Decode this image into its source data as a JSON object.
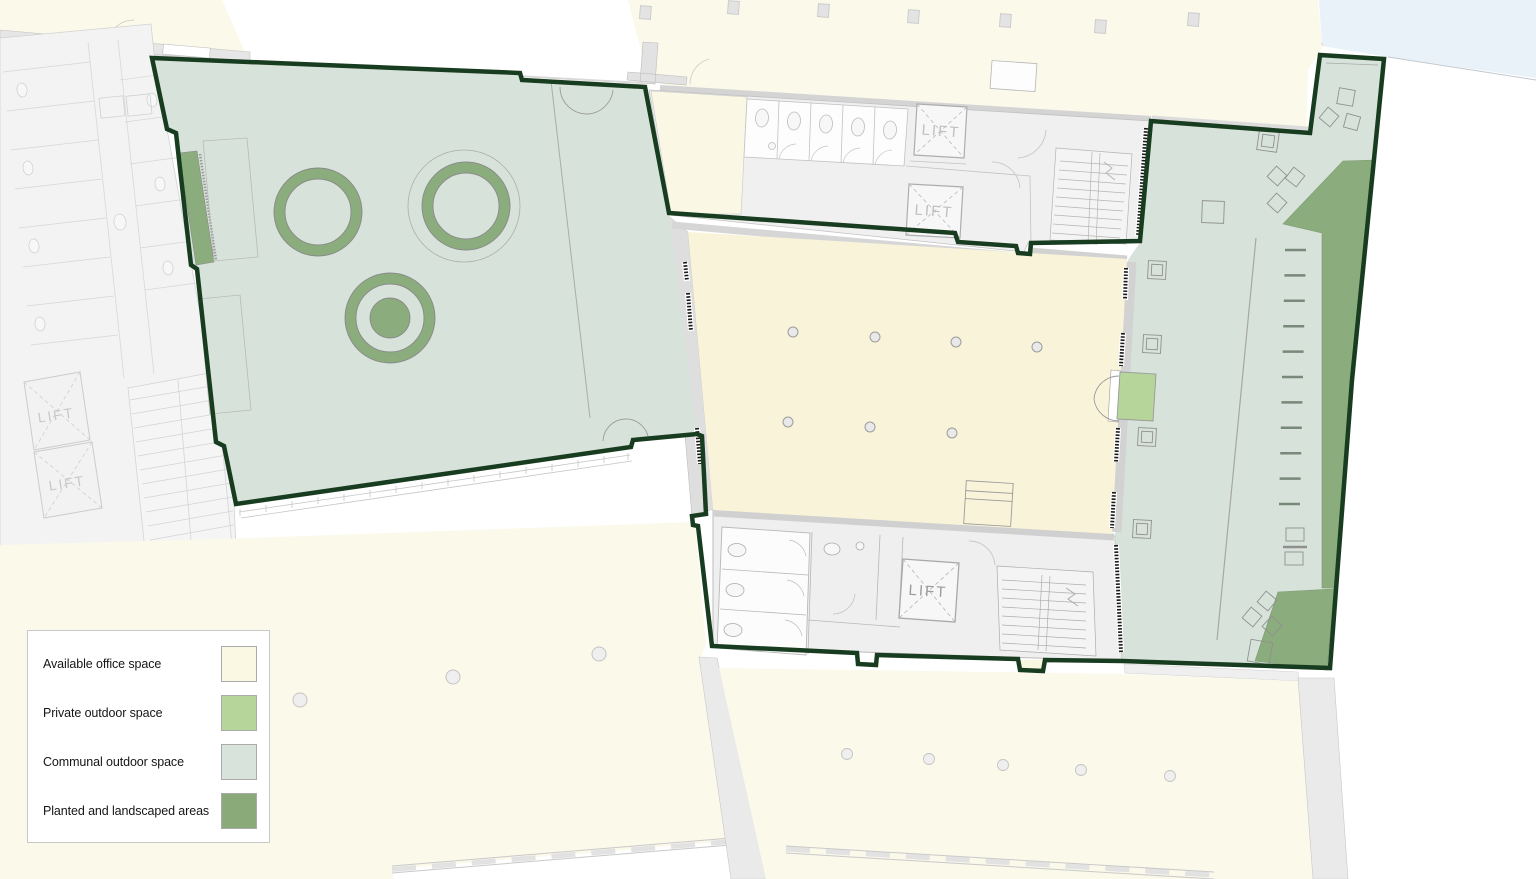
{
  "plan_title": "floor-plan",
  "labels": {
    "lift": "LIFT"
  },
  "legend": {
    "items": [
      {
        "label": "Available office space",
        "color": "#FAF8E3"
      },
      {
        "label": "Private outdoor space",
        "color": "#B5D59B"
      },
      {
        "label": "Communal outdoor space",
        "color": "#D8E4DB"
      },
      {
        "label": "Planted and landscaped areas",
        "color": "#8AAA7A"
      }
    ]
  },
  "colors": {
    "office": "#F9F4D9",
    "neighbor_cream": "#FBF9EA",
    "communal": "#D7E3DA",
    "private": "#B5D59B",
    "planted": "#8BAC7D",
    "boundary": "#183C1F",
    "water": "#EAF2F9",
    "core": "#F0F0F0",
    "wall": "#D8D8D8"
  }
}
